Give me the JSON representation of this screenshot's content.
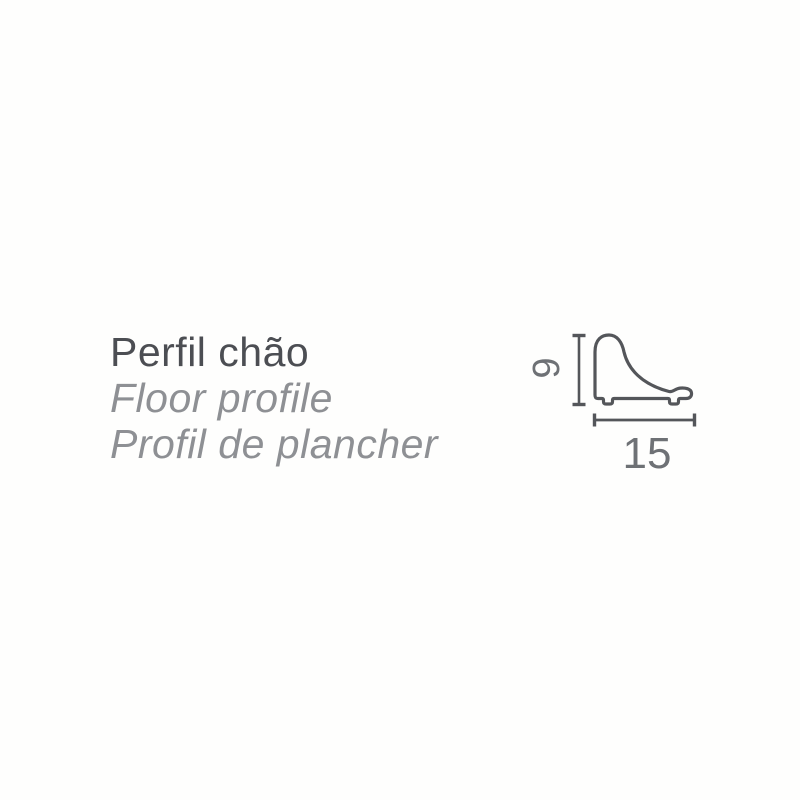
{
  "product": {
    "name_pt": "Perfil chão",
    "name_en": "Floor profile",
    "name_fr": "Profil de plancher"
  },
  "diagram": {
    "type": "technical cross-section drawing",
    "subject": "floor profile moulding",
    "height_label": "9",
    "width_label": "15"
  },
  "colors": {
    "background": "#fefefd",
    "title_text": "#4c4e53",
    "subtitle_text": "#8e9094",
    "outline_stroke": "#54565a",
    "dimension_line": "#54565a",
    "dimension_text": "#6e7175"
  }
}
